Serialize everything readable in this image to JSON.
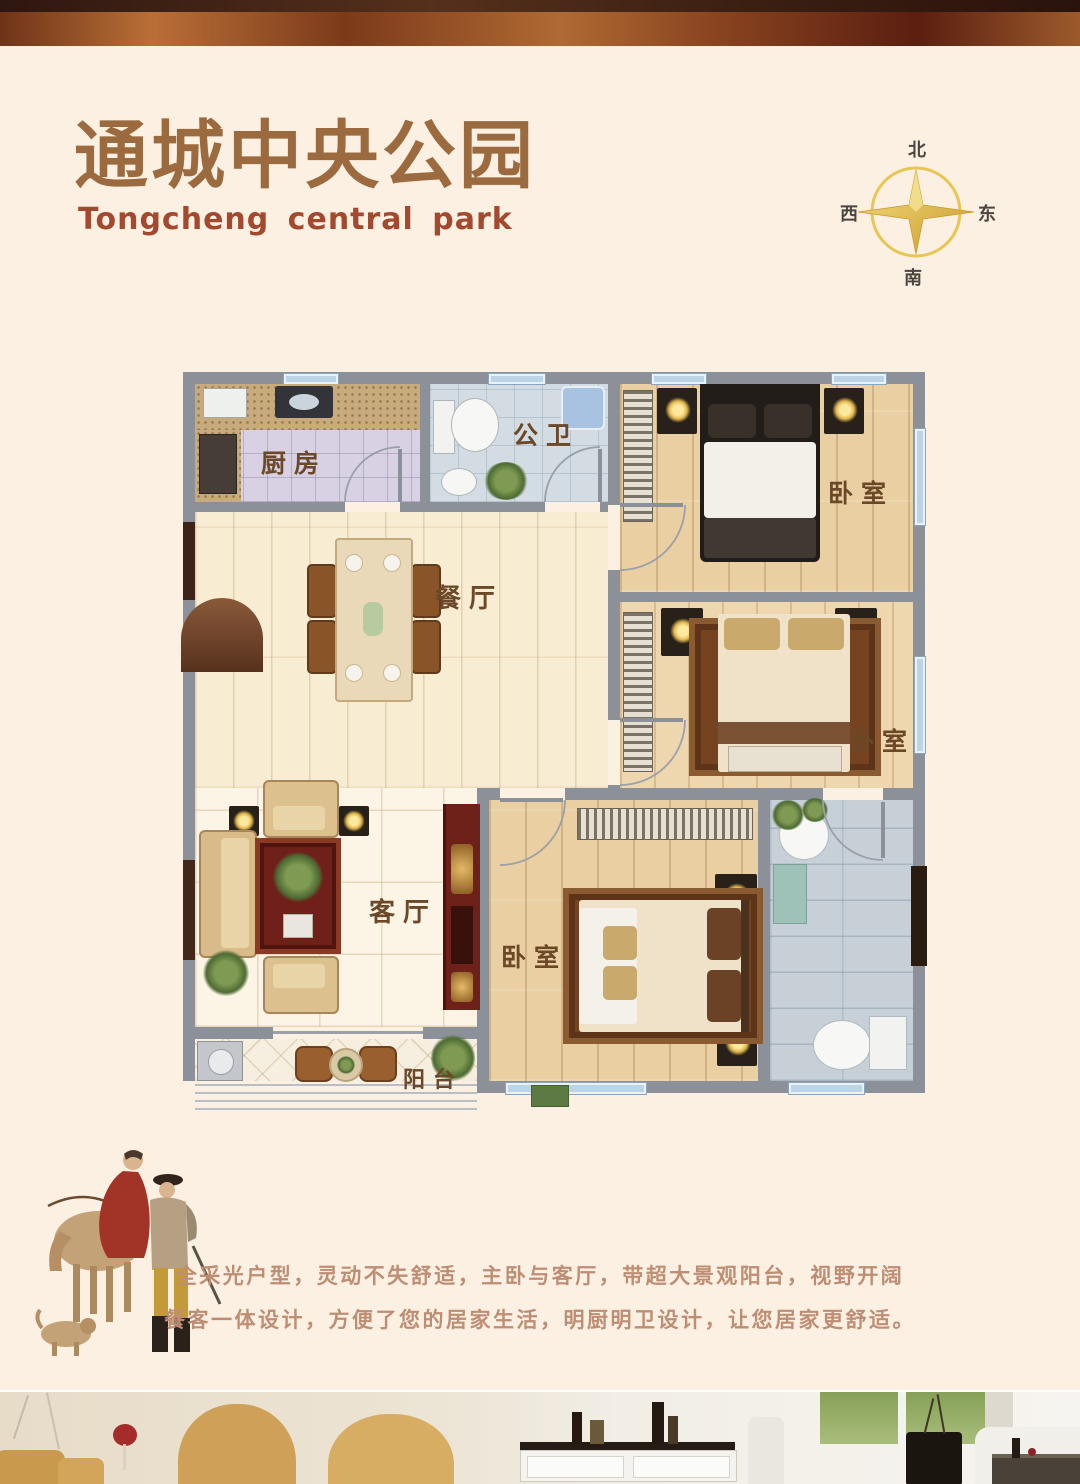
{
  "header": {
    "title": "通城中央公园",
    "subtitle": "Tongcheng central park"
  },
  "compass": {
    "north": "北",
    "south": "南",
    "east": "东",
    "west": "西"
  },
  "floorplan": {
    "rooms": {
      "kitchen": "厨房",
      "public_bath": "公卫",
      "dining": "餐厅",
      "living": "客厅",
      "balcony": "阳台",
      "bedroom_top": "卧室",
      "bedroom_middle": "卧室",
      "bedroom_master": "卧室"
    }
  },
  "description": {
    "line1": "全采光户型，灵动不失舒适，主卧与客厅，带超大景观阳台，视野开阔",
    "line2": "餐客一体设计，方便了您的居家生活，明厨明卫设计，让您居家更舒适。"
  },
  "colors": {
    "title_brown": "#9c6a3f",
    "subtitle_rust": "#a3492f",
    "copper_bar": "#a05a28",
    "wall_gray": "#8c9099",
    "compass_gold": "#e7c34b",
    "page_bg": "#fcf0e2"
  }
}
